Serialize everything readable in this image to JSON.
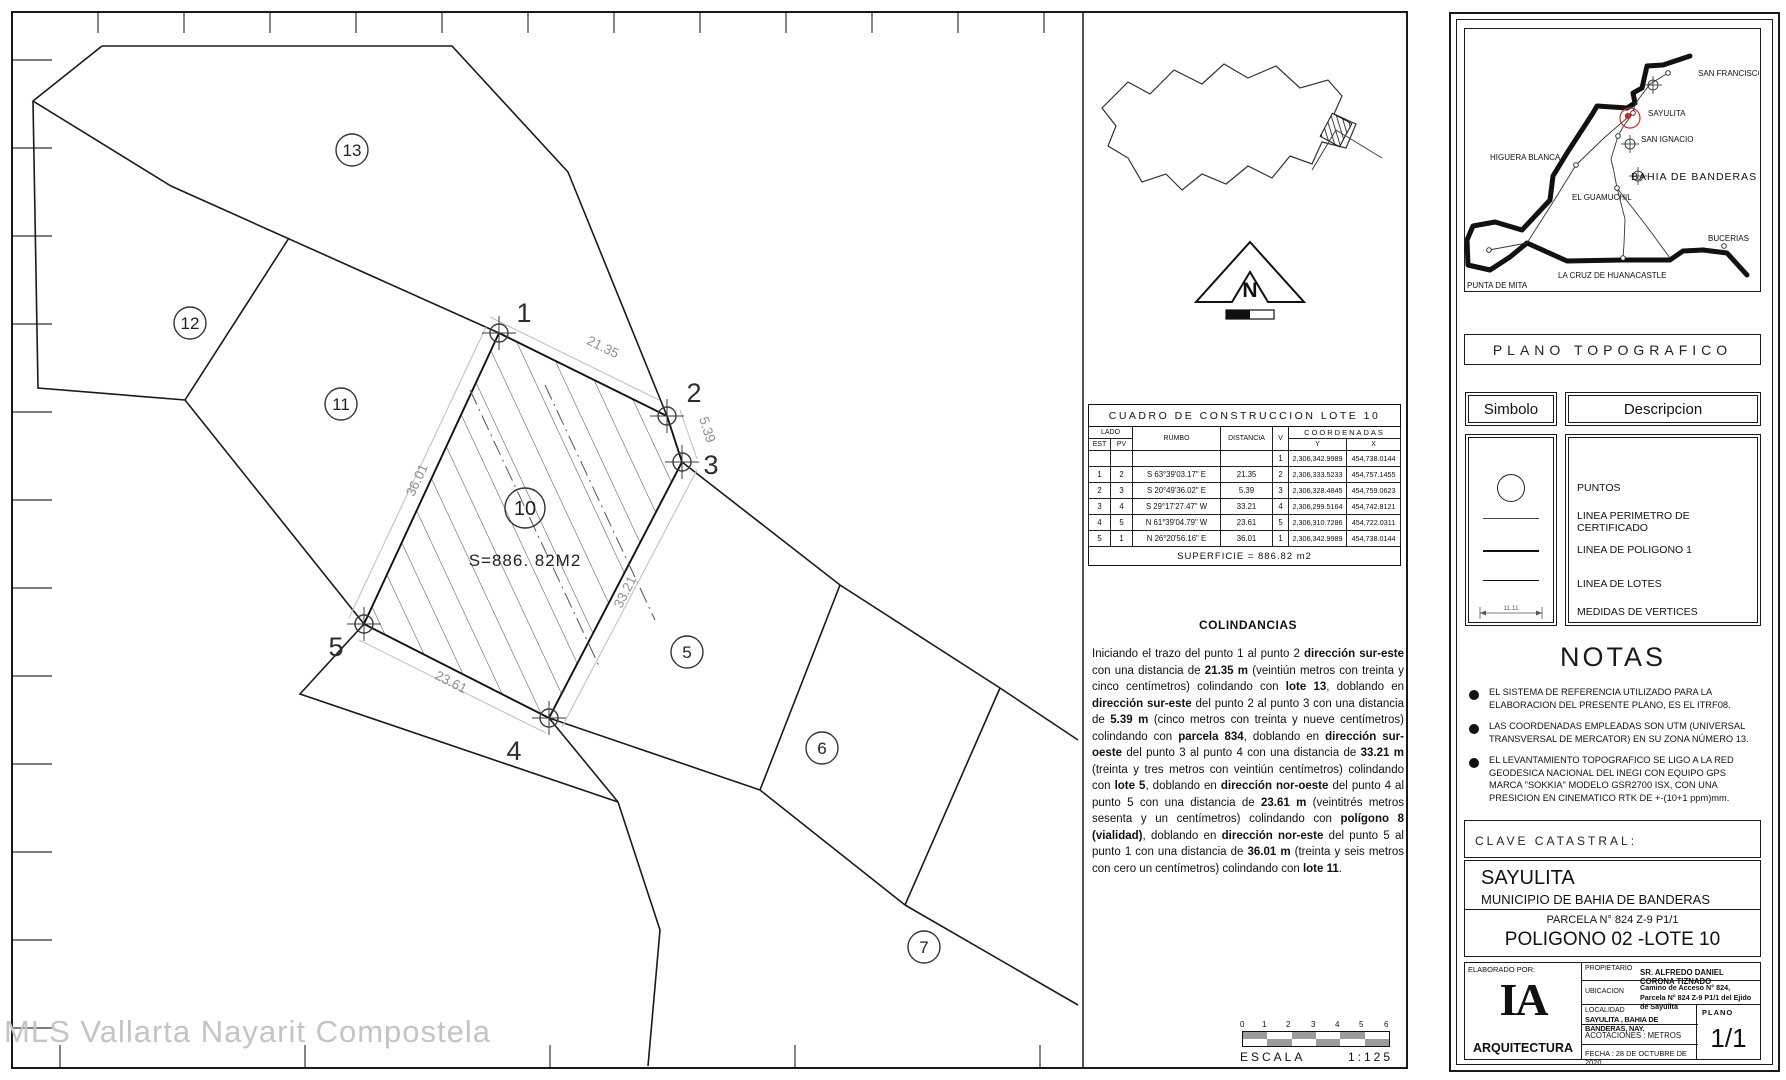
{
  "watermark": "MLS Vallarta Nayarit Compostela",
  "drawing": {
    "area_label": "S=886. 82M2",
    "lot_labels": [
      "13",
      "12",
      "11",
      "10",
      "5",
      "6",
      "7"
    ],
    "vertex_labels": [
      "1",
      "2",
      "3",
      "4",
      "5"
    ],
    "dim_labels": [
      "21.35",
      "5.39",
      "33.21",
      "23.61",
      "36.01"
    ]
  },
  "north_label": "N",
  "construction_table": {
    "title": "CUADRO DE CONSTRUCCION LOTE 10",
    "headers": {
      "lado": "LADO",
      "est": "EST",
      "pv": "PV",
      "rumbo": "RUMBO",
      "distancia": "DISTANCIA",
      "v": "V",
      "coordenadas": "COORDENADAS",
      "y": "Y",
      "x": "X"
    },
    "rows": [
      {
        "est": "",
        "pv": "",
        "rumbo": "",
        "dist": "",
        "v": "1",
        "y": "2,306,342.9989",
        "x": "454,738.0144"
      },
      {
        "est": "1",
        "pv": "2",
        "rumbo": "S 63°39'03.17\" E",
        "dist": "21.35",
        "v": "2",
        "y": "2,306,333.5233",
        "x": "454,757.1455"
      },
      {
        "est": "2",
        "pv": "3",
        "rumbo": "S 20°49'36.02\" E",
        "dist": "5.39",
        "v": "3",
        "y": "2,306,328.4845",
        "x": "454,759.0623"
      },
      {
        "est": "3",
        "pv": "4",
        "rumbo": "S 29°17'27.47\" W",
        "dist": "33.21",
        "v": "4",
        "y": "2,306,299.5164",
        "x": "454,742.8121"
      },
      {
        "est": "4",
        "pv": "5",
        "rumbo": "N 61°39'04.79\" W",
        "dist": "23.61",
        "v": "5",
        "y": "2,306,310.7286",
        "x": "454,722.0311"
      },
      {
        "est": "5",
        "pv": "1",
        "rumbo": "N 26°20'56.16\" E",
        "dist": "36.01",
        "v": "1",
        "y": "2,306,342.9989",
        "x": "454,738.0144"
      }
    ],
    "superficie": "SUPERFICIE  =  886.82  m2"
  },
  "colindancias": {
    "title": "COLINDANCIAS",
    "segments": [
      {
        "t": "Iniciando el trazo del punto 1 al punto 2 ",
        "b": false
      },
      {
        "t": "dirección sur-este",
        "b": true
      },
      {
        "t": " con una distancia de ",
        "b": false
      },
      {
        "t": "21.35 m",
        "b": true
      },
      {
        "t": " (veintiún metros con treinta y cinco centímetros) colindando con ",
        "b": false
      },
      {
        "t": "lote 13",
        "b": true
      },
      {
        "t": ", doblando en ",
        "b": false
      },
      {
        "t": "dirección sur-este",
        "b": true
      },
      {
        "t": " del punto 2 al punto 3 con una distancia de ",
        "b": false
      },
      {
        "t": "5.39 m",
        "b": true
      },
      {
        "t": " (cinco metros con treinta y nueve centímetros) colindando con ",
        "b": false
      },
      {
        "t": "parcela 834",
        "b": true
      },
      {
        "t": ", doblando en ",
        "b": false
      },
      {
        "t": "dirección sur-oeste",
        "b": true
      },
      {
        "t": " del punto 3 al punto 4 con una distancia de ",
        "b": false
      },
      {
        "t": "33.21 m",
        "b": true
      },
      {
        "t": " (treinta y tres metros con veintiún centímetros) colindando con ",
        "b": false
      },
      {
        "t": "lote 5",
        "b": true
      },
      {
        "t": ", doblando en ",
        "b": false
      },
      {
        "t": "dirección nor-oeste",
        "b": true
      },
      {
        "t": " del punto 4 al punto 5 con una distancia de ",
        "b": false
      },
      {
        "t": "23.61 m",
        "b": true
      },
      {
        "t": " (veintitrés metros sesenta y un centímetros) colindando con ",
        "b": false
      },
      {
        "t": "polígono 8 (vialidad)",
        "b": true
      },
      {
        "t": ", doblando en ",
        "b": false
      },
      {
        "t": "dirección nor-este",
        "b": true
      },
      {
        "t": " del punto 5 al punto 1 con una distancia de ",
        "b": false
      },
      {
        "t": "36.01 m",
        "b": true
      },
      {
        "t": " (treinta y seis metros con cero un centímetros) colindando con ",
        "b": false
      },
      {
        "t": "lote 11",
        "b": true
      },
      {
        "t": ".",
        "b": false
      }
    ]
  },
  "scalebar": {
    "ticks": [
      "0",
      "1",
      "2",
      "3",
      "4",
      "5",
      "6"
    ],
    "escala_label": "ESCALA",
    "ratio": "1:125"
  },
  "location_map": {
    "towns": [
      "SAN FRANCISCO",
      "SAYULITA",
      "SAN IGNACIO",
      "HIGUERA BLANCA",
      "BAHIA DE BANDERAS",
      "EL GUAMUCHIL",
      "BUCERIAS",
      "LA CRUZ DE HUANACASTLE",
      "PUNTA DE MITA"
    ],
    "highlight_color": "#c23128"
  },
  "plano_topografico": "PLANO TOPOGRAFICO",
  "legend": {
    "simbolo": "Simbolo",
    "descripcion": "Descripcion",
    "items": [
      "PUNTOS",
      "LINEA PERIMETRO DE CERTIFICADO",
      "LINEA DE POLIGONO 1",
      "LINEA DE LOTES",
      "MEDIDAS DE VERTICES"
    ],
    "medidas_value": "11.11"
  },
  "notas": {
    "title": "NOTAS",
    "items": [
      "EL SISTEMA DE REFERENCIA UTILIZADO PARA LA ELABORACION DEL PRESENTE PLANO, ES EL ITRF08.",
      "LAS COORDENADAS EMPLEADAS SON UTM (UNIVERSAL TRANSVERSAL DE MERCATOR) EN SU ZONA NÚMERO 13.",
      "EL  LEVANTAMIENTO TOPOGRAFICO SE LIGO A LA RED GEODESICA NACIONAL DEL INEGI CON EQUIPO GPS MARCA  \"SOKKIA\"  MODELO GSR2700 ISX, CON UNA PRESICION EN CINEMATICO RTK DE +-(10+1 ppm)mm."
    ]
  },
  "clave_catastral": "CLAVE  CATASTRAL:",
  "location_block": {
    "locality": "SAYULITA",
    "municipio": "MUNICIPIO DE BAHIA DE BANDERAS",
    "parcela": "PARCELA N° 824 Z-9 P1/1",
    "poligono": "POLIGONO 02 -LOTE 10"
  },
  "title_block": {
    "elaborado_por": "ELABORADO POR:",
    "logo_main": "IA",
    "logo_sub": "ARQUITECTURA",
    "propietario_label": "PROPIETARIO",
    "propietario": "SR. ALFREDO DANIEL CORONA TIZNADO",
    "ubicacion_label": "UBICACION",
    "ubicacion_1": "Camino de Acceso N° 824,",
    "ubicacion_2": "Parcela N° 824 Z-9 P1/1 del Ejido de Sayulita",
    "localidad_label": "LOCALIDAD",
    "localidad": "SAYULITA , BAHIA DE BANDERAS, NAY.",
    "acotaciones": "ACOTACIONES : METROS",
    "fecha": "FECHA :   28 DE OCTUBRE DE 2020",
    "plano_label": "PLANO",
    "plano_value": "1/1"
  }
}
